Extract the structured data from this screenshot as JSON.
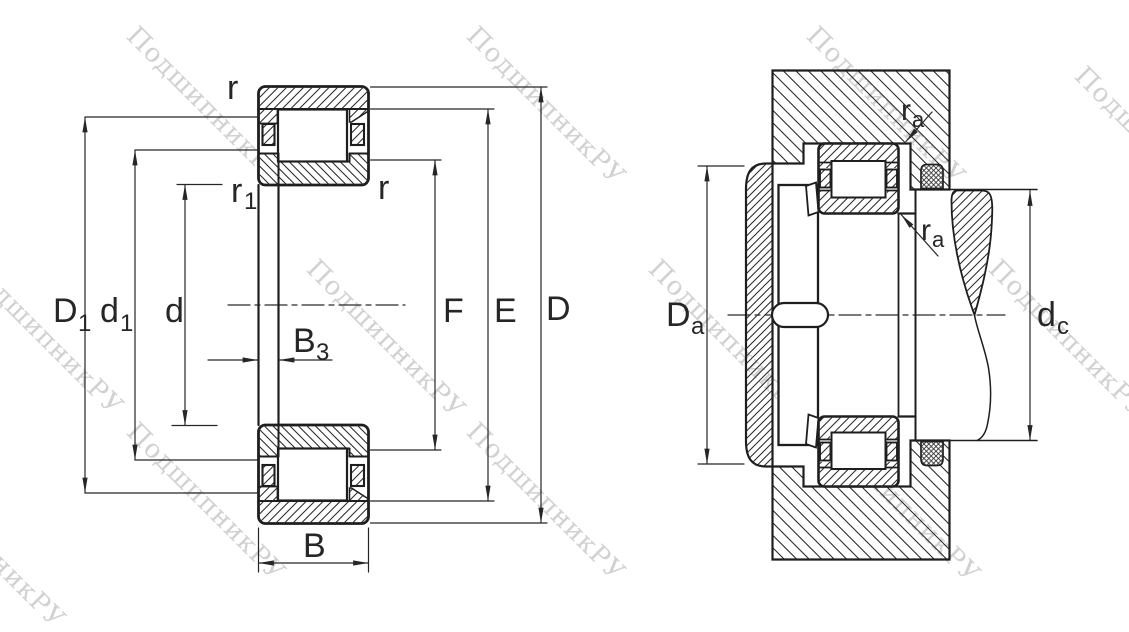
{
  "colors": {
    "background": "#ffffff",
    "line": "#262626",
    "watermark": "#c9c9c9"
  },
  "watermark": {
    "text": "ПодшипникРУ"
  },
  "left_view": {
    "description": "bearing cross-section drawing",
    "labels": {
      "r_top": {
        "main": "r"
      },
      "r1": {
        "main": "r",
        "sub": "1"
      },
      "r_right": {
        "main": "r"
      },
      "D1": {
        "main": "D",
        "sub": "1"
      },
      "d1": {
        "main": "d",
        "sub": "1"
      },
      "d": {
        "main": "d"
      },
      "B3": {
        "main": "B",
        "sub": "3"
      },
      "B": {
        "main": "B"
      },
      "F": {
        "main": "F"
      },
      "E": {
        "main": "E"
      },
      "D": {
        "main": "D"
      }
    }
  },
  "right_view": {
    "description": "bearing mounting arrangement drawing",
    "labels": {
      "ra_top": {
        "main": "r",
        "sub": "a"
      },
      "ra_bottom": {
        "main": "r",
        "sub": "a"
      },
      "Da": {
        "main": "D",
        "sub": "a"
      },
      "dc": {
        "main": "d",
        "sub": "c"
      }
    }
  }
}
